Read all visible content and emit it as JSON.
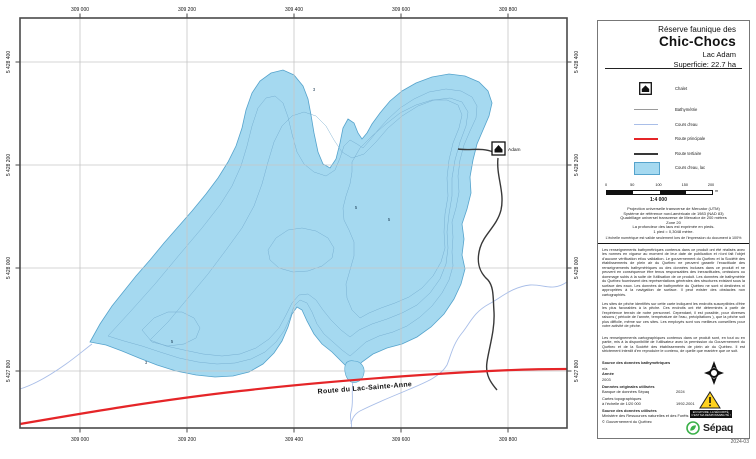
{
  "title": {
    "region": "Réserve faunique des",
    "park": "Chic-Chocs",
    "lake": "Lac Adam",
    "area": "Superficie:  22.7 ha"
  },
  "legend": {
    "items": [
      {
        "label": "Chalet"
      },
      {
        "label": "Bathymétrie"
      },
      {
        "label": "Cours d'eau"
      },
      {
        "label": "Route principale"
      },
      {
        "label": "Route tertiaire"
      },
      {
        "label": "Cours d'eau, lac"
      }
    ]
  },
  "scalebar": {
    "ticks": [
      "0",
      "50",
      "100",
      "150",
      "200"
    ],
    "unit": "m",
    "ratio": "1:4 000"
  },
  "projection": {
    "lines": [
      "Projection universelle transverse de Mercator (UTM)",
      "Système de référence nord-américain de 1983 (NAD 83)",
      "Quadrillage universel transverse de Mercator de 200 mètres",
      "Zone 20",
      "La profondeur des lacs est exprimée en pieds.",
      "1 pied = 0,3048 mètre."
    ]
  },
  "note": "L'échelle numérique est valide seulement lors de l'impression du document à 100%",
  "disclaimers": [
    "Les renseignements bathymétriques contenus dans ce produit ont été réalisés avec les normes en vigueur au moment de leur date de publication et n'ont fait l'objet d'aucune vérification et/ou validation. Le gouvernement du Québec et la Société des établissements de plein air du Québec ne peuvent garantir l'exactitude des renseignements bathymétriques ou des données incluses dans ce produit et ne peuvent en conséquence être tenus responsables des inexactitudes, omissions ou dommage subis à la suite de l'utilisation de ce produit. Les données de bathymétrie du Québec fournissent des représentations générales des structures existant sous la surface des eaux. Les données de bathymétrie du Québec ne sont ni destinées ni appropriées à la navigation de surface. Il peut exister des obstacles non cartographiés.",
    "Les sites de pêche identifiés sur cette carte indiquent les endroits susceptibles d'être les plus favorables à la pêche. Ces endroits ont été déterminés à partir de l'expérience terrain de notre personnel. Cependant, il est possible, pour diverses raisons ( période de l'année, température de l'eau, précipitations ), que la pêche soit plus difficile, même sur ces sites. Les employés sont vos meilleurs conseillers pour votre activité de pêche.",
    "Les renseignements cartographiques contenus dans ce produit sont, en tout ou en partie, mis à la disponibilité de l'utilisateur avec la permission du Gouvernement du Québec et de la Société des établissements de plein air du Québec. Il est strictement interdit d'en reproduire le contenu, de quelle que manière que ce soit."
  ],
  "sources": {
    "bathy_header": "Source des données bathymétriques",
    "bathy_value": "n/a",
    "year_label": "Année",
    "year_value": "2003",
    "orig_header": "Données originales utilisées",
    "orig_name": "Banque de données Sépaq",
    "orig_year": "2024",
    "topo_name": "Cartes topographiques",
    "topo_scale": "à l'échelle de 1/20 000",
    "topo_years": "1992-2001",
    "used_header": "Source des données utilisées",
    "used_name": "Ministère des Ressources naturelles et des Forêts",
    "used_copyright": "© Gouvernement du Québec"
  },
  "warning": {
    "line1": "EN NATURE, LA SÉCURITÉ,",
    "line2": "C'EST MA RESPONSABILITÉ !"
  },
  "logo": {
    "brand": "Sépaq"
  },
  "version": "2024-03",
  "map": {
    "xlabels": [
      "309 000",
      "309 200",
      "309 400",
      "309 600",
      "309 800"
    ],
    "ylabels": [
      "5 428 400",
      "5 428 200",
      "5 428 000",
      "5 427 800"
    ],
    "chalet": "Adam",
    "road": "Route du Lac-Sainte-Anne",
    "depths": [
      "3",
      "5",
      "5",
      "5",
      "3"
    ]
  },
  "colors": {
    "lake_fill": "#A5D9F0",
    "lake_stroke": "#55A3CC",
    "contour": "#70A8CC",
    "stream": "#A9BEE8",
    "road_main": "#E52528",
    "road_tertiary": "#383838",
    "grid": "#C6C6C6",
    "frame": "#4A4A4A",
    "sepaq_green": "#3CB14A",
    "warning_yellow": "#FFD21E"
  }
}
